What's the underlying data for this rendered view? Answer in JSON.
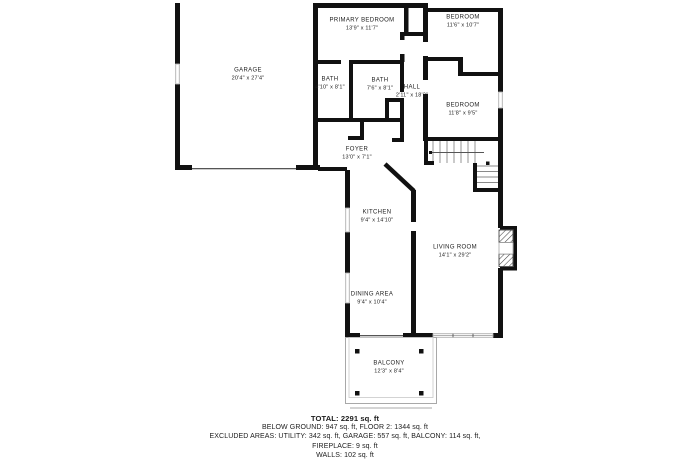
{
  "colors": {
    "wall": "#111111",
    "background": "#ffffff",
    "window_outline": "#b0b0b0",
    "stair_tread": "#8a8a8a",
    "text": "#222222"
  },
  "rooms": {
    "garage": {
      "name": "GARAGE",
      "dims": "20'4\" x 27'4\""
    },
    "primary_bedroom": {
      "name": "PRIMARY BEDROOM",
      "dims": "13'9\" x 11'7\""
    },
    "bedroom_top": {
      "name": "BEDROOM",
      "dims": "11'6\" x 10'7\""
    },
    "bath_small": {
      "name": "BATH",
      "dims": "4'10\" x 8'1\""
    },
    "bath_large": {
      "name": "BATH",
      "dims": "7'6\" x 8'1\""
    },
    "hall": {
      "name": "HALL",
      "dims": "2'11\" x 18'2\""
    },
    "bedroom_mid": {
      "name": "BEDROOM",
      "dims": "11'8\" x 9'5\""
    },
    "foyer": {
      "name": "FOYER",
      "dims": "13'0\" x 7'1\""
    },
    "kitchen": {
      "name": "KITCHEN",
      "dims": "9'4\" x 14'10\""
    },
    "living_room": {
      "name": "LIVING ROOM",
      "dims": "14'1\" x 29'2\""
    },
    "dining_area": {
      "name": "DINING AREA",
      "dims": "9'4\" x 10'4\""
    },
    "balcony": {
      "name": "BALCONY",
      "dims": "12'3\" x 8'4\""
    }
  },
  "summary": {
    "total": "TOTAL: 2291 sq. ft",
    "below_ground": "BELOW GROUND: 947 sq. ft, FLOOR 2: 1344 sq. ft",
    "excluded": "EXCLUDED AREAS: UTILITY: 342 sq. ft, GARAGE: 557 sq. ft, BALCONY: 114 sq. ft,",
    "fireplace": "FIREPLACE: 9 sq. ft",
    "walls": "WALLS: 102 sq. ft"
  }
}
